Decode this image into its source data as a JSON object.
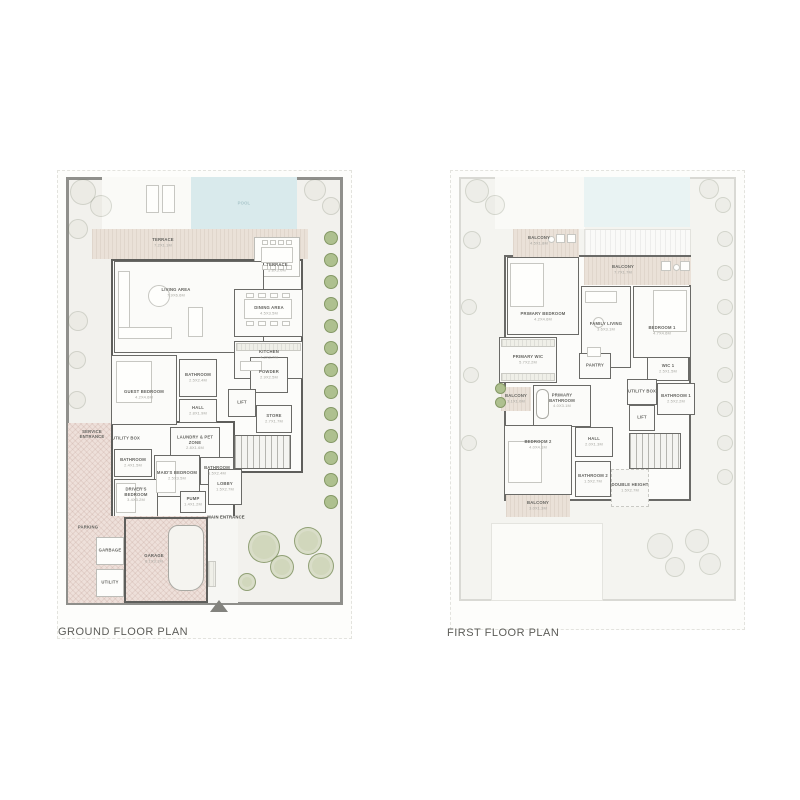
{
  "page": {
    "background": "#ffffff"
  },
  "palette": {
    "wall": "#6a6a67",
    "site_wall": "#8f8f8b",
    "pool": "#d9eaec",
    "terrace": "#eae1d8",
    "garden": "#ced8b3",
    "parking": "#eee0da",
    "title_text": "#5d5d59",
    "label_text": "#63635f",
    "dims_text": "#a4a49e"
  },
  "north_arrow": {
    "icon": "north-arrow-icon",
    "shape": "triangle-up"
  },
  "plans": [
    {
      "id": "ground",
      "title": "GROUND FLOOR PLAN",
      "rooms": [
        {
          "id": "pool",
          "label": "POOL",
          "dims": ""
        },
        {
          "id": "terrace-top",
          "label": "TERRACE",
          "dims": "7.2X1.1M"
        },
        {
          "id": "terrace-table",
          "label": "TERRACE",
          "dims": "5.8X3.0M"
        },
        {
          "id": "living-area",
          "label": "LIVING AREA",
          "dims": "7.9X6.6M"
        },
        {
          "id": "dining-area",
          "label": "DINING AREA",
          "dims": "4.5X3.5M"
        },
        {
          "id": "kitchen",
          "label": "KITCHEN",
          "dims": "4.2X2.7M"
        },
        {
          "id": "guest-bedroom",
          "label": "GUEST BEDROOM",
          "dims": "4.2X4.6M"
        },
        {
          "id": "bathroom-guest",
          "label": "BATHROOM",
          "dims": "2.5X2.4M"
        },
        {
          "id": "hall",
          "label": "HALL",
          "dims": "2.8X1.9M"
        },
        {
          "id": "powder",
          "label": "POWDER",
          "dims": "2.9X2.5M"
        },
        {
          "id": "lift",
          "label": "LIFT",
          "dims": ""
        },
        {
          "id": "store",
          "label": "STORE",
          "dims": "2.7X1.7M"
        },
        {
          "id": "service-entrance",
          "label": "SERVICE ENTRANCE",
          "dims": ""
        },
        {
          "id": "utility-box",
          "label": "UTILITY BOX",
          "dims": ""
        },
        {
          "id": "laundry-pet-zone",
          "label": "LAUNDRY & PET ZONE",
          "dims": "2.8X1.6M"
        },
        {
          "id": "bathroom-maids",
          "label": "BATHROOM",
          "dims": "2.4X1.5M"
        },
        {
          "id": "maids-bedroom",
          "label": "MAID'S BEDROOM",
          "dims": "2.5X3.5M"
        },
        {
          "id": "bathroom-2g",
          "label": "BATHROOM",
          "dims": "1.5X2.4M"
        },
        {
          "id": "drivers-bedroom",
          "label": "DRIVER'S BEDROOM",
          "dims": "3.4X3.2M"
        },
        {
          "id": "pump",
          "label": "PUMP",
          "dims": "1.4X1.2M"
        },
        {
          "id": "lobby",
          "label": "LOBBY",
          "dims": "1.5X2.7M"
        },
        {
          "id": "main-entrance",
          "label": "MAIN ENTRANCE",
          "dims": ""
        },
        {
          "id": "parking",
          "label": "PARKING",
          "dims": ""
        },
        {
          "id": "garbage",
          "label": "GARBAGE",
          "dims": ""
        },
        {
          "id": "utility",
          "label": "UTILITY",
          "dims": ""
        },
        {
          "id": "garage",
          "label": "GARAGE",
          "dims": "6.1X3.1M"
        }
      ]
    },
    {
      "id": "first",
      "title": "FIRST FLOOR PLAN",
      "rooms": [
        {
          "id": "balcony-1",
          "label": "BALCONY",
          "dims": "4.5X1.8M"
        },
        {
          "id": "balcony-2",
          "label": "BALCONY",
          "dims": "7.7X1.7M"
        },
        {
          "id": "primary-bedroom",
          "label": "PRIMARY BEDROOM",
          "dims": "4.2X4.6M"
        },
        {
          "id": "family-living",
          "label": "FAMILY LIVING",
          "dims": "3.6X3.1M"
        },
        {
          "id": "bedroom-1",
          "label": "BEDROOM 1",
          "dims": "4.7X4.6M"
        },
        {
          "id": "primary-wic",
          "label": "PRIMARY WIC",
          "dims": "5.7X2.2M"
        },
        {
          "id": "pantry",
          "label": "PANTRY",
          "dims": ""
        },
        {
          "id": "wic-1",
          "label": "WIC 1",
          "dims": "2.5X1.5M"
        },
        {
          "id": "utility-box-f",
          "label": "UTILITY BOX",
          "dims": ""
        },
        {
          "id": "bathroom-1",
          "label": "BATHROOM 1",
          "dims": "2.5X2.2M"
        },
        {
          "id": "lift-f",
          "label": "LIFT",
          "dims": ""
        },
        {
          "id": "balcony-3",
          "label": "BALCONY",
          "dims": "3.1X1.0M"
        },
        {
          "id": "primary-bathroom",
          "label": "PRIMARY BATHROOM",
          "dims": "4.0X3.1M"
        },
        {
          "id": "bedroom-2",
          "label": "BEDROOM 2",
          "dims": "4.0X4.1M"
        },
        {
          "id": "hall-f",
          "label": "HALL",
          "dims": "2.0X1.3M"
        },
        {
          "id": "bathroom-2",
          "label": "BATHROOM 2",
          "dims": "1.5X2.7M"
        },
        {
          "id": "double-height",
          "label": "DOUBLE HEIGHT",
          "dims": "1.5X2.7M"
        },
        {
          "id": "balcony-4",
          "label": "BALCONY",
          "dims": "3.0X1.3M"
        }
      ]
    }
  ]
}
